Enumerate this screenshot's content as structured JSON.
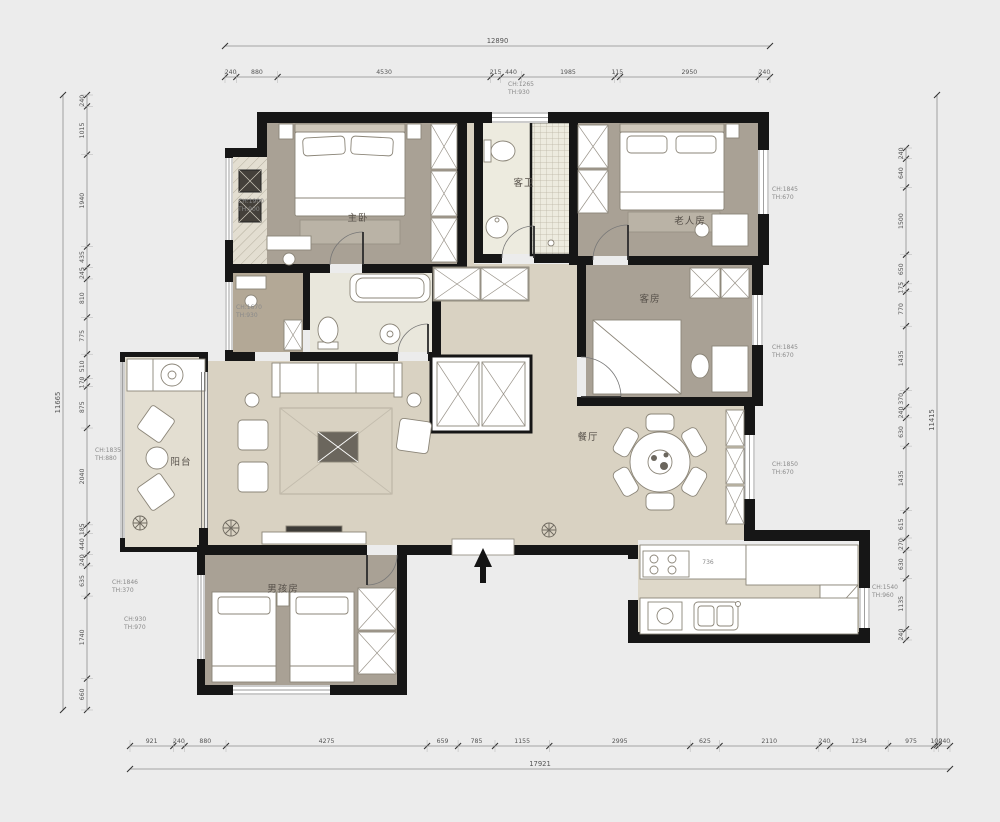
{
  "plan": {
    "rooms": [
      {
        "id": "master-bedroom",
        "label": "主卧"
      },
      {
        "id": "guest-bathroom",
        "label": "客卫"
      },
      {
        "id": "elder-room",
        "label": "老人房"
      },
      {
        "id": "guest-room",
        "label": "客房"
      },
      {
        "id": "dining-room",
        "label": "餐厅"
      },
      {
        "id": "balcony",
        "label": "阳台"
      },
      {
        "id": "boys-room",
        "label": "男孩房"
      }
    ],
    "window_annotations": [
      {
        "id": "master-left",
        "lines": [
          "CH:1900",
          "TH:900"
        ]
      },
      {
        "id": "bath-top",
        "lines": [
          "CH:1265",
          "TH:930"
        ]
      },
      {
        "id": "dressing-left",
        "lines": [
          "CH:1670",
          "TH:930"
        ]
      },
      {
        "id": "elder-right",
        "lines": [
          "CH:1845",
          "TH:670"
        ]
      },
      {
        "id": "guest-right",
        "lines": [
          "CH:1845",
          "TH:670"
        ]
      },
      {
        "id": "dining-right",
        "lines": [
          "CH:1850",
          "TH:670"
        ]
      },
      {
        "id": "kitchen-right",
        "lines": [
          "CH:1540",
          "TH:960"
        ]
      },
      {
        "id": "balcony-left",
        "lines": [
          "CH:1835",
          "TH:880"
        ]
      },
      {
        "id": "boys-left-upper",
        "lines": [
          "CH:1846",
          "TH:370"
        ]
      },
      {
        "id": "boys-left-lower",
        "lines": [
          "CH:930",
          "TH:970"
        ]
      }
    ],
    "counter_note": "736",
    "dimensions": {
      "top": {
        "total": "12890",
        "segments": [
          "240",
          "880",
          "4530",
          "215",
          "440",
          "1985",
          "115",
          "2950",
          "240"
        ]
      },
      "bottom": {
        "total": "17921",
        "segments": [
          "921",
          "240",
          "880",
          "4275",
          "659",
          "785",
          "1155",
          "2995",
          "625",
          "2110",
          "240",
          "1234",
          "975",
          "100",
          "240"
        ]
      },
      "left": {
        "total": "11665",
        "segments": [
          "240",
          "1015",
          "1940",
          "435",
          "245",
          "810",
          "775",
          "510",
          "170",
          "875",
          "2040",
          "185",
          "440",
          "240",
          "635",
          "1740",
          "660"
        ]
      },
      "right": {
        "total": "11415",
        "segments": [
          "240",
          "640",
          "1500",
          "650",
          "175",
          "770",
          "1435",
          "370",
          "240",
          "630",
          "1435",
          "615",
          "270",
          "630",
          "1135",
          "240"
        ]
      }
    }
  }
}
